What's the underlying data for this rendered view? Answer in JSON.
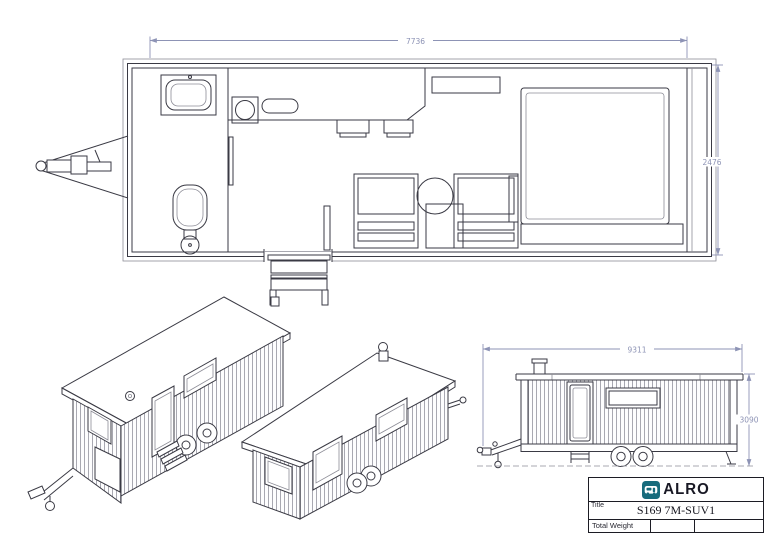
{
  "colors": {
    "paper": "#ffffff",
    "line_color": "#3a3a44",
    "light_color": "#8d8d97",
    "dim_color": "#8d93b5",
    "logo_teal": "#176b7c",
    "ink": "#181824"
  },
  "plan_view": {
    "length_dim": "7736",
    "width_dim": "2476"
  },
  "elevation_view": {
    "length_dim": "9311",
    "height_dim": "3090"
  },
  "title_block": {
    "logo_text": "ALRO",
    "logo_icon": "caravan-icon",
    "title_label": "Title",
    "title_value": "S169 7M-SUV1",
    "weight_label": "Total Weight"
  }
}
